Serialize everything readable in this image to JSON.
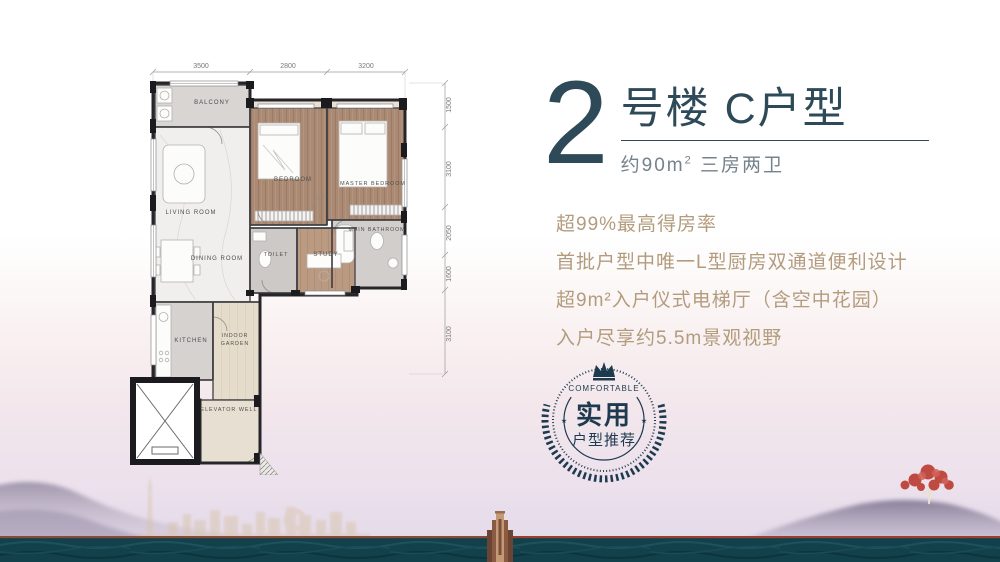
{
  "title": {
    "building_number": "2",
    "name": "号楼 C户型",
    "spec_area": "约90m",
    "spec_sup": "2",
    "spec_rooms": " 三房两卫"
  },
  "features": [
    "超99%最高得房率",
    "首批户型中唯一L型厨房双通道便利设计",
    "超9m²入户仪式电梯厅（含空中花园）",
    "入户尽享约5.5m景观视野"
  ],
  "badge": {
    "top_label": "COMFORTABLE",
    "main_label": "实用",
    "sub_label": "户型推荐",
    "star": "★"
  },
  "floorplan": {
    "dims_top": [
      "3500",
      "2800",
      "3200"
    ],
    "dims_right": [
      "1500",
      "3100",
      "2050",
      "1600",
      "3100"
    ],
    "rooms": {
      "balcony": "BALCONY",
      "living": "LIVING ROOM",
      "dining": "DINING ROOM",
      "bedroom": "BEDROOM",
      "master": "MASTER BEDROOM",
      "bathroom": "MAIN BATHROOM",
      "toilet": "TOILET",
      "study": "STUDY",
      "kitchen": "KITCHEN",
      "garden1": "INDOOR",
      "garden2": "GARDEN",
      "elevator": "ELEVATOR WELL"
    }
  },
  "colors": {
    "title_navy": "#2e4a58",
    "subtitle_grey": "#75828c",
    "feature_tan": "#b39c7d",
    "badge_navy": "#1e3a4e",
    "band_teal": "#12414b",
    "band_line_brown": "#8a4a38",
    "mountain_purple": "#a49aae",
    "skyline_tan": "#d9c3ab",
    "tree_red": "#bf4a42",
    "wall_dark": "#26262a"
  }
}
